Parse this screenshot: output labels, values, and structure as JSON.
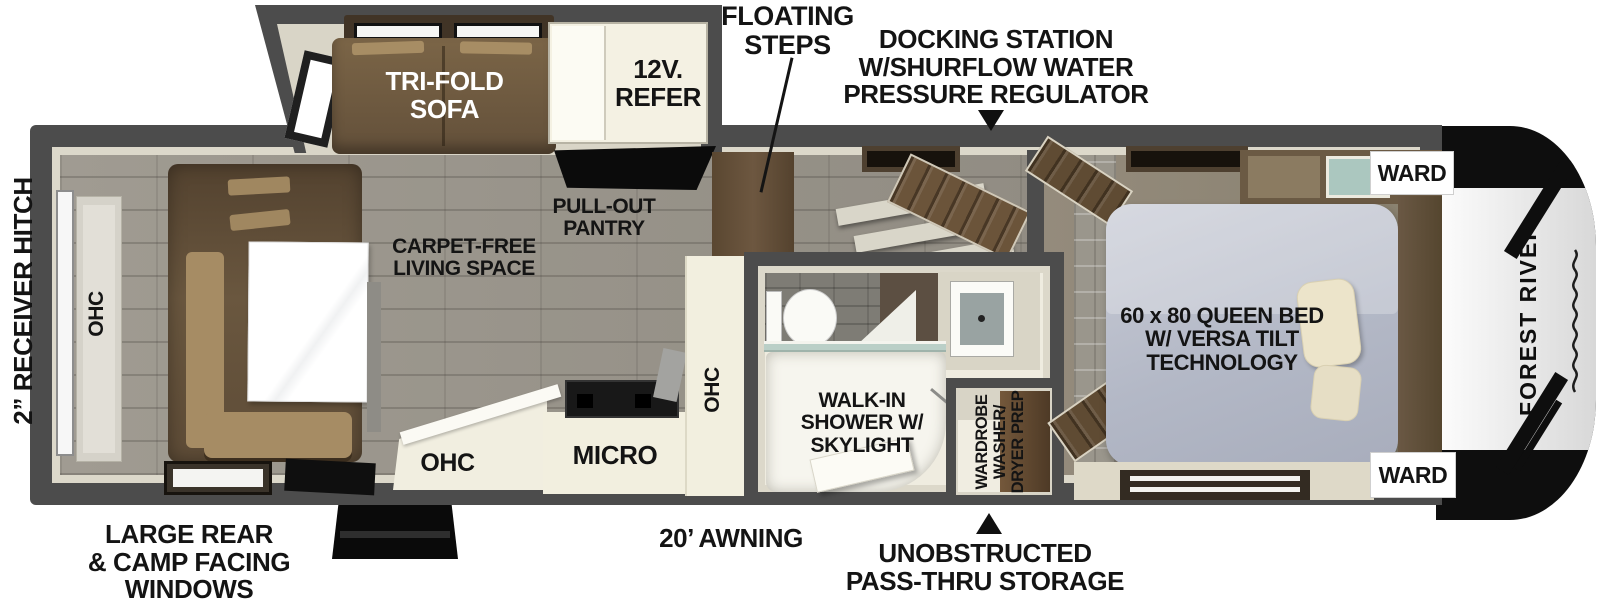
{
  "annotations": {
    "floating_steps": "FLOATING\nSTEPS",
    "docking_station": "DOCKING STATION\nW/SHURFLOW WATER\nPRESSURE REGULATOR",
    "receiver_hitch": "2” RECEIVER HITCH",
    "rear_windows": "LARGE REAR\n& CAMP FACING\nWINDOWS",
    "awning": "20’ AWNING",
    "pass_thru_storage": "UNOBSTRUCTED\nPASS-THRU STORAGE"
  },
  "living": {
    "tri_fold_sofa": "TRI-FOLD\nSOFA",
    "refer": "12V.\nREFER",
    "pull_out_pantry": "PULL-OUT\nPANTRY",
    "carpet_free": "CARPET-FREE\nLIVING SPACE",
    "rear_ohc": "OHC"
  },
  "kitchen": {
    "ohc_left": "OHC",
    "micro": "MICRO",
    "ohc_column": "OHC"
  },
  "bathroom": {
    "walk_in_shower": "WALK-IN\nSHOWER W/\nSKYLIGHT",
    "wardrobe_wd": "WARDROBE\nWASHER/\nDRYER PREP"
  },
  "bedroom": {
    "queen_bed": "60 x 80 QUEEN BED\nW/ VERSA TILT\nTECHNOLOGY",
    "ward_top": "WARD",
    "ward_bottom": "WARD"
  },
  "brand": {
    "name": "FOREST RIVER"
  },
  "colors": {
    "wall": "#4c4c4c",
    "lining": "#dcd8ca",
    "floor": "#9a958b",
    "bedroom_floor": "#8d8476",
    "wood": "#6b543a",
    "sofa": "#6e5a40",
    "counter": "#f2efdf",
    "bed": "#b9bdc9",
    "label": "#141414"
  }
}
